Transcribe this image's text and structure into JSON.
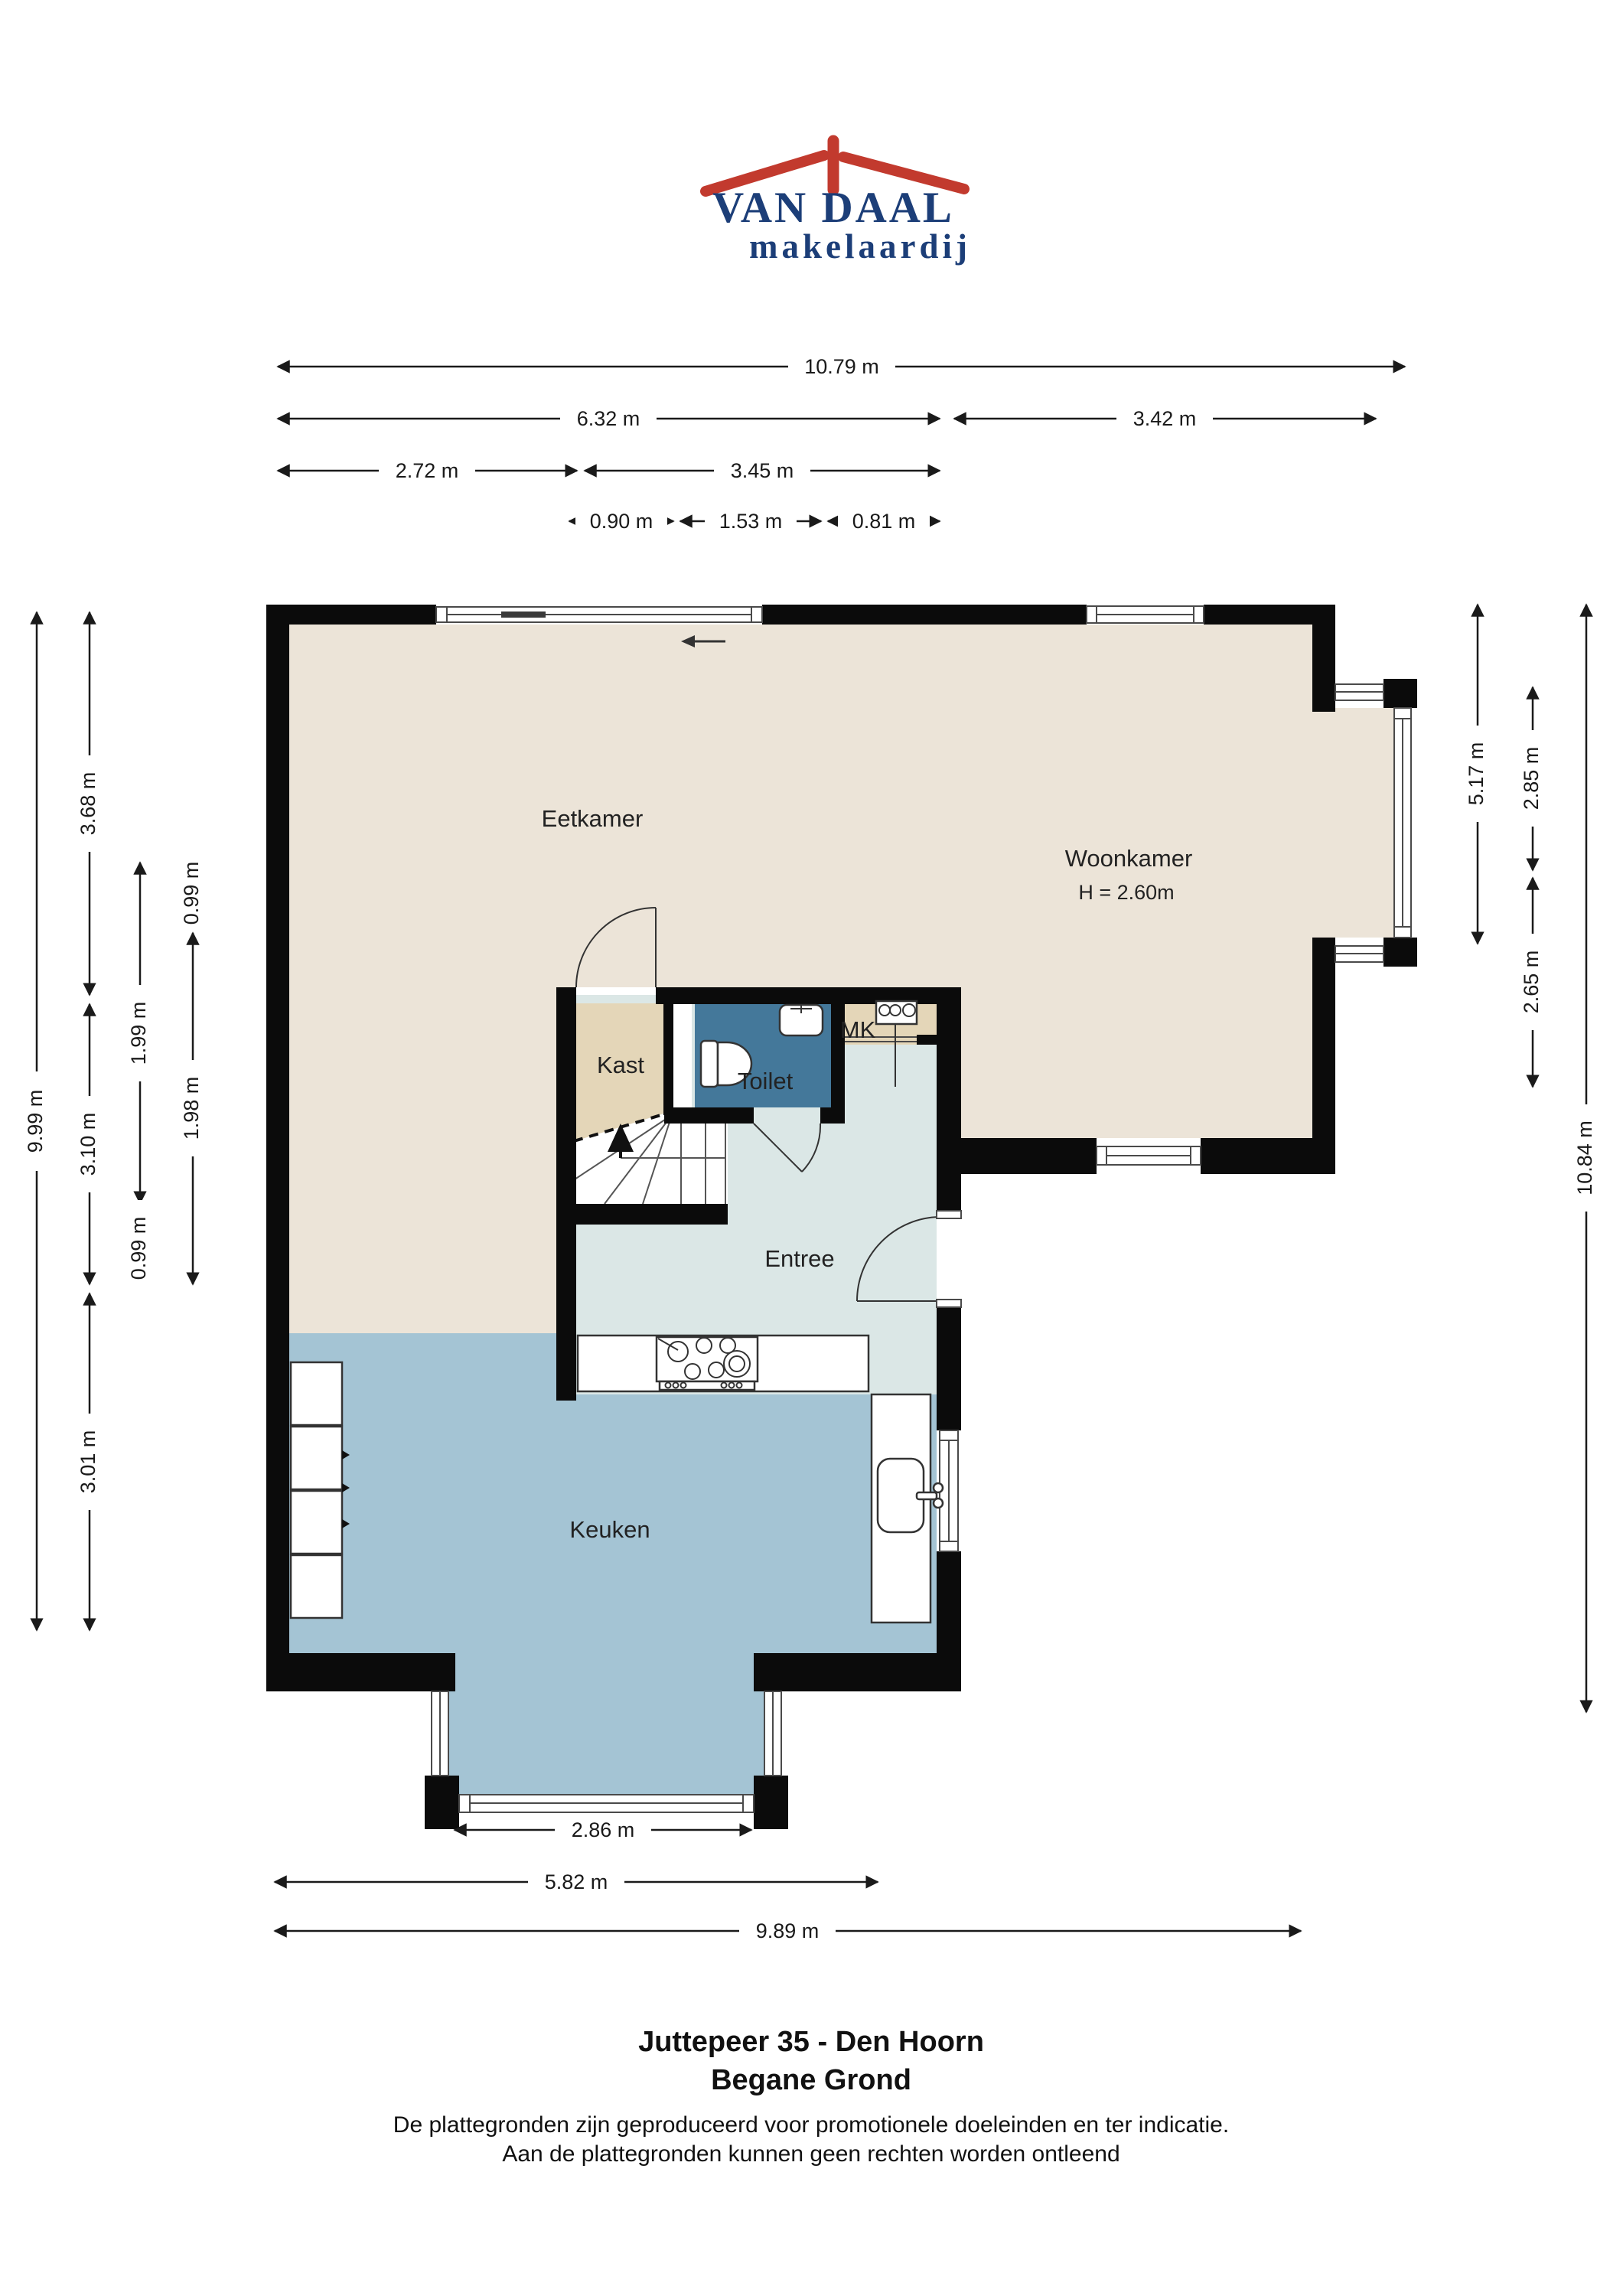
{
  "logo": {
    "line1": "VAN DAAL",
    "line2": "makelaardij",
    "roof_color": "#c23a2e",
    "text_color": "#1c3e78",
    "roof_icon": "roof-with-chimney-icon"
  },
  "rooms": {
    "eetkamer": "Eetkamer",
    "woonkamer": "Woonkamer",
    "woonkamer_height": "H = 2.60m",
    "kast": "Kast",
    "toilet": "Toilet",
    "mk": "MK",
    "entree": "Entree",
    "keuken": "Keuken"
  },
  "dimensions": {
    "top": [
      {
        "label": "10.79 m"
      },
      {
        "label": "6.32 m"
      },
      {
        "label": "3.42 m"
      },
      {
        "label": "2.72 m"
      },
      {
        "label": "3.45 m"
      },
      {
        "label": "0.90 m"
      },
      {
        "label": "1.53 m"
      },
      {
        "label": "0.81 m"
      }
    ],
    "left": [
      {
        "label": "9.99 m"
      },
      {
        "label": "3.68 m"
      },
      {
        "label": "3.10 m"
      },
      {
        "label": "3.01 m"
      },
      {
        "label": "1.99 m"
      },
      {
        "label": "0.99 m"
      },
      {
        "label": "0.99 m"
      },
      {
        "label": "1.98 m"
      }
    ],
    "right": [
      {
        "label": "5.17 m"
      },
      {
        "label": "2.85 m"
      },
      {
        "label": "2.65 m"
      },
      {
        "label": "10.84 m"
      }
    ],
    "bottom": [
      {
        "label": "2.86 m"
      },
      {
        "label": "5.82 m"
      },
      {
        "label": "9.89 m"
      }
    ]
  },
  "fixtures": [
    "sliding-door",
    "gas-hob",
    "kitchen-sink",
    "toilet",
    "hand-basin",
    "meter-board",
    "staircase",
    "entry-door",
    "interior-door",
    "kitchen-cabinets"
  ],
  "colors": {
    "floor_living": "#ece4d8",
    "floor_closet": "#e4d6b8",
    "floor_toilet": "#44789a",
    "floor_hall": "#dbe7e6",
    "floor_kitchen": "#a4c4d4",
    "wall": "#0b0b0b"
  },
  "footer": {
    "title_line1": "Juttepeer 35 - Den Hoorn",
    "title_line2": "Begane Grond",
    "disclaimer_line1": "De plattegronden zijn geproduceerd voor promotionele doeleinden en ter indicatie.",
    "disclaimer_line2": "Aan de plattegronden kunnen geen rechten worden ontleend"
  }
}
